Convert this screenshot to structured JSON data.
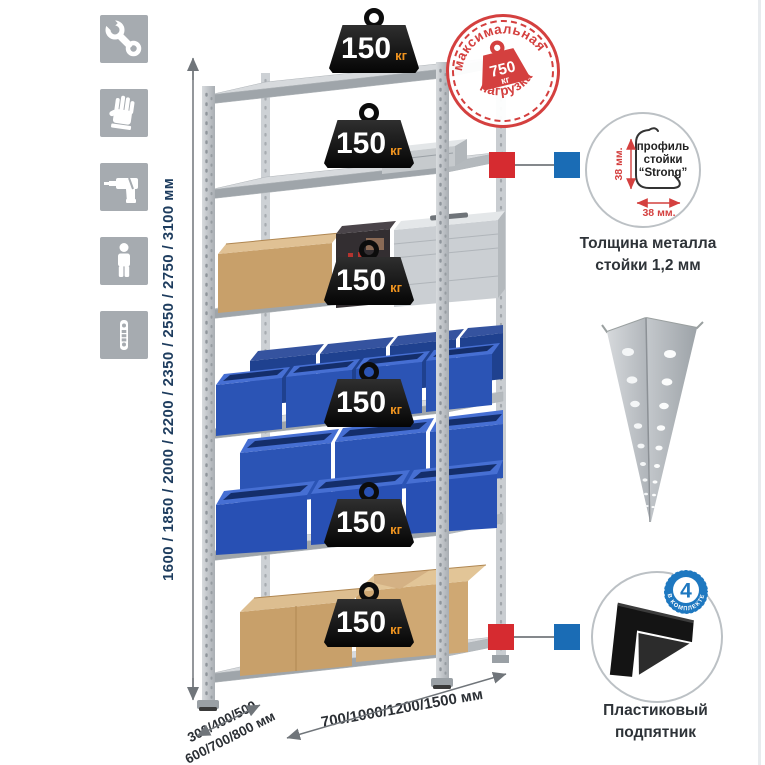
{
  "assembly_icons": {
    "items": [
      {
        "name": "wrench"
      },
      {
        "name": "gloves"
      },
      {
        "name": "drill"
      },
      {
        "name": "person"
      },
      {
        "name": "perforated-strip"
      }
    ]
  },
  "dimensions": {
    "height_label": "1600 / 1850 / 2000 / 2200 / 2350 / 2550 / 2750 / 3100 мм",
    "depth_label_line1": "300/400/500",
    "depth_label_line2": "600/700/800 мм",
    "width_label": "700/1000/1200/1500 мм"
  },
  "rack": {
    "shelves": [
      {
        "load_value": "150",
        "load_unit": "кг",
        "content": "empty"
      },
      {
        "load_value": "150",
        "load_unit": "кг",
        "content": "aluminum case"
      },
      {
        "load_value": "150",
        "load_unit": "кг",
        "content": "cardboard box and aluminum cases"
      },
      {
        "load_value": "150",
        "load_unit": "кг",
        "content": "blue plastic bins"
      },
      {
        "load_value": "150",
        "load_unit": "кг",
        "content": "blue plastic bins"
      },
      {
        "load_value": "150",
        "load_unit": "кг",
        "content": "cardboard boxes"
      }
    ]
  },
  "max_load_stamp": {
    "arc_top": "максимальная",
    "arc_bottom": "нагрузка",
    "value": "750",
    "unit": "кг"
  },
  "profile_detail": {
    "label_line1": "профиль",
    "label_line2": "стойки",
    "label_line3": "“Strong”",
    "dim_vertical": "38 мм.",
    "dim_horizontal": "38 мм.",
    "caption_line1": "Толщина металла",
    "caption_line2": "стойки 1,2 мм"
  },
  "foot_detail": {
    "badge_value": "4",
    "badge_arc": "в комплекте",
    "caption_line1": "Пластиковый",
    "caption_line2": "подпятник"
  },
  "colors": {
    "stamp_red": "#d4403f",
    "marker_red": "#d62b30",
    "marker_blue": "#1a6cb5",
    "bin_blue": "#2b54b5",
    "metal_gray": "#c6cacd",
    "icon_tile_gray": "#a6abb0",
    "height_text_navy": "#1d3c5e",
    "load_unit_orange": "#f0941f"
  }
}
